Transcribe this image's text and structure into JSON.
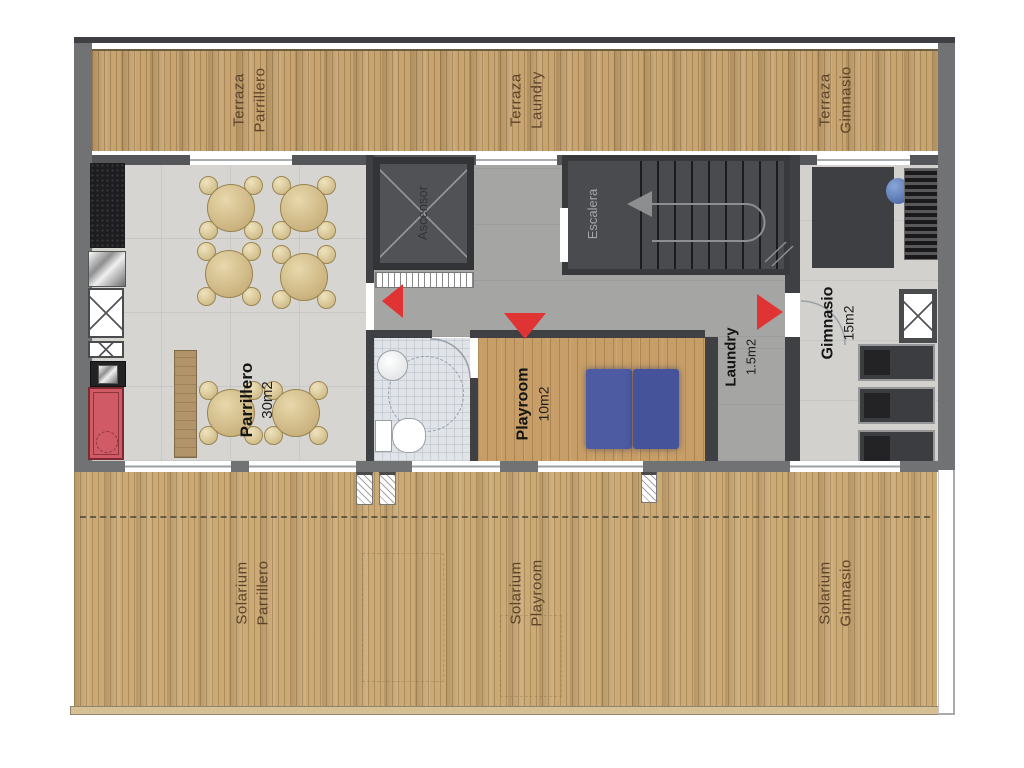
{
  "document": {
    "type": "floor-plan",
    "level": "rooftop amenities plan"
  },
  "colors": {
    "deck_wood": "#c8a470",
    "interior_floor": "#d6d5d2",
    "corridor_floor": "#a5a6a4",
    "dark_room": "#4b4c4e",
    "wall_gray": "#707274",
    "accent_red": "#e03434",
    "grill_red": "#d05b66",
    "mat_blue": "#4b5aa2",
    "table_tan": "#d8c498",
    "label_brown": "#5c432a"
  },
  "terraces": {
    "parrillero": {
      "l1": "Terraza",
      "l2": "Parrillero"
    },
    "laundry": {
      "l1": "Terraza",
      "l2": "Laundry"
    },
    "gimnasio": {
      "l1": "Terraza",
      "l2": "Gimnasio"
    }
  },
  "rooms": {
    "parrillero": {
      "name": "Parrillero",
      "area": "30m2"
    },
    "ascensor": {
      "name": "Ascensor"
    },
    "escalera": {
      "name": "Escalera"
    },
    "laundry": {
      "name": "Laundry",
      "area": "1.5m2"
    },
    "gimnasio": {
      "name": "Gimnasio",
      "area": "15m2"
    },
    "playroom": {
      "name": "Playroom",
      "area": "10m2"
    }
  },
  "solariums": {
    "parrillero": {
      "l1": "Solarium",
      "l2": "Parrillero"
    },
    "playroom": {
      "l1": "Solarium",
      "l2": "Playroom"
    },
    "gimnasio": {
      "l1": "Solarium",
      "l2": "Gimnasio"
    }
  }
}
